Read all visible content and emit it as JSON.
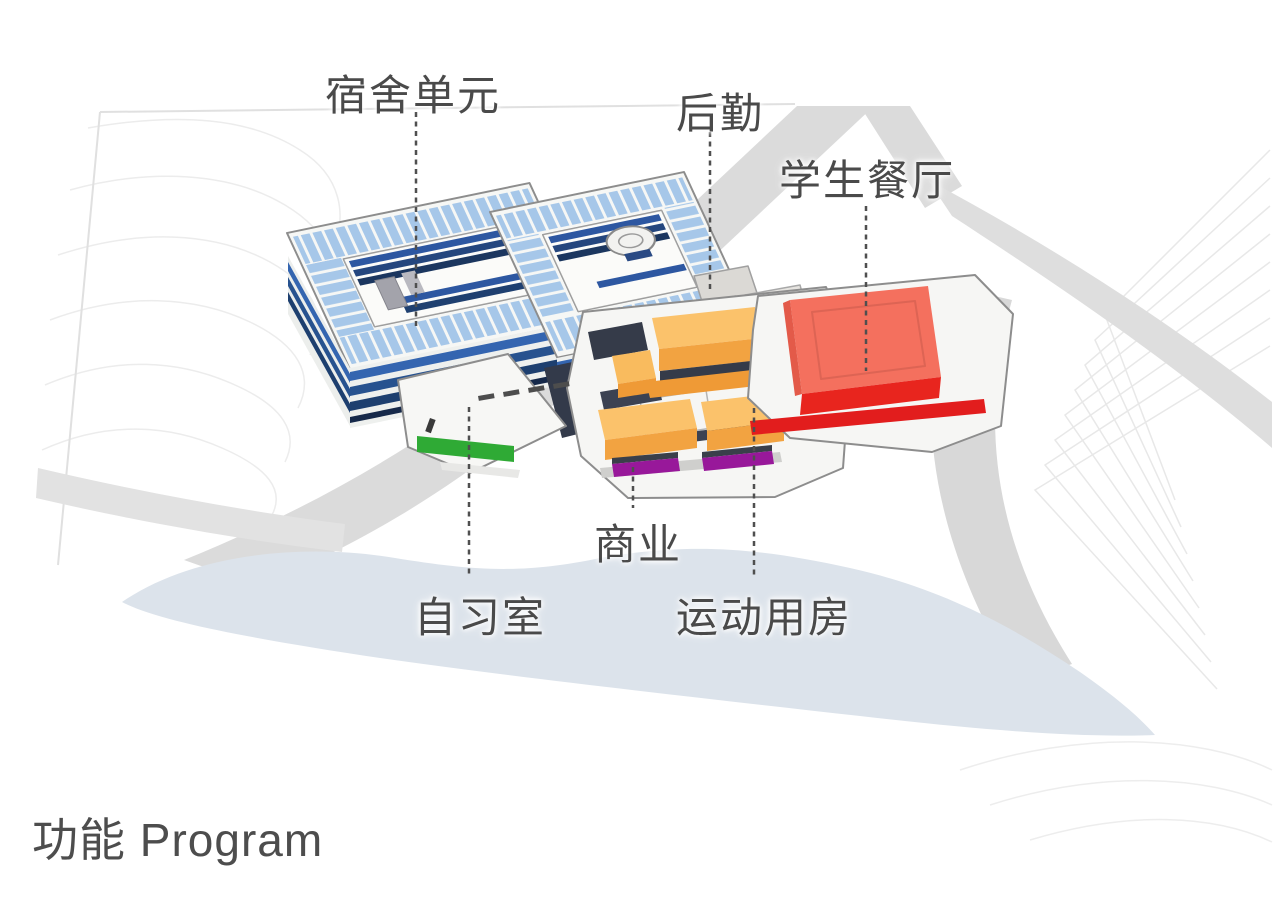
{
  "title": {
    "text": "功能 Program"
  },
  "labels": {
    "dormitory": {
      "text": "宿舍单元"
    },
    "logistics": {
      "text": "后勤"
    },
    "cafeteria": {
      "text": "学生餐厅"
    },
    "commercial": {
      "text": "商业"
    },
    "study": {
      "text": "自习室"
    },
    "sports": {
      "text": "运动用房"
    }
  },
  "colors": {
    "dormitory_roof_blue": "#a6c7e9",
    "dormitory_facade_blue": "#2e5aa6",
    "cafeteria_roof_red": "#f4705e",
    "cafeteria_side_red": "#e8251e",
    "sports_orange": "#fbc26b",
    "commercial_purple": "#98189a",
    "study_green": "#2faa35",
    "water_blue_gray": "#dce3eb",
    "road_gray": "#dbdbdb",
    "label_text": "#4a4a4a"
  }
}
